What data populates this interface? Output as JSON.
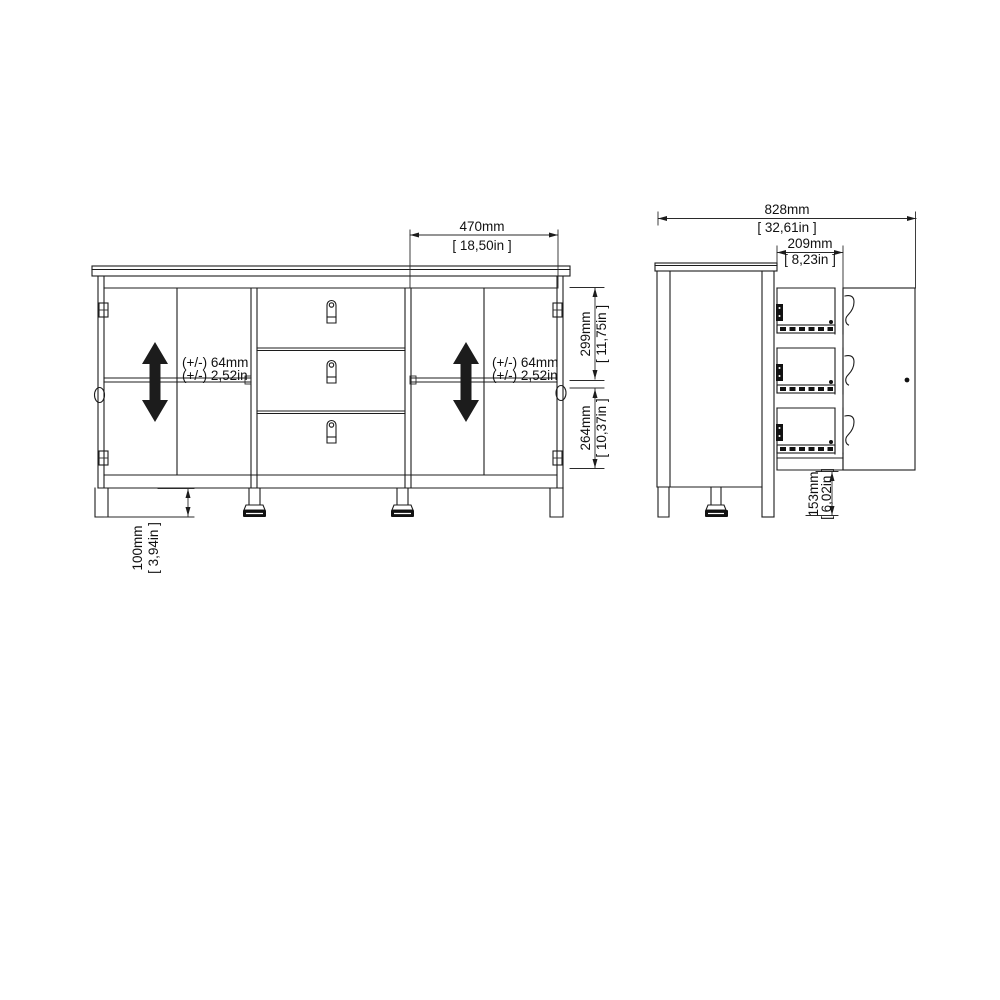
{
  "front": {
    "door_width_mm": "470mm",
    "door_width_in": "[ 18,50in ]",
    "upper_height_mm": "299mm",
    "upper_height_in": "[ 11,75in ]",
    "lower_height_mm": "264mm",
    "lower_height_in": "[ 10,37in ]",
    "leg_height_mm": "100mm",
    "leg_height_in": "[ 3,94in ]",
    "shelf_left_mm": "(+/-) 64mm",
    "shelf_left_in": "(+/-) 2,52in",
    "shelf_right_mm": "(+/-) 64mm",
    "shelf_right_in": "(+/-) 2,52in"
  },
  "side": {
    "clearance_mm": "828mm",
    "clearance_in": "[ 32,61in ]",
    "drawer_depth_mm": "209mm",
    "drawer_depth_in": "[ 8,23in ]",
    "leg_height_mm": "153mm",
    "leg_height_in": "[ 6,02in ]"
  },
  "colors": {
    "line": "#1c1c1c",
    "background": "#ffffff",
    "arrow": "#111111"
  }
}
